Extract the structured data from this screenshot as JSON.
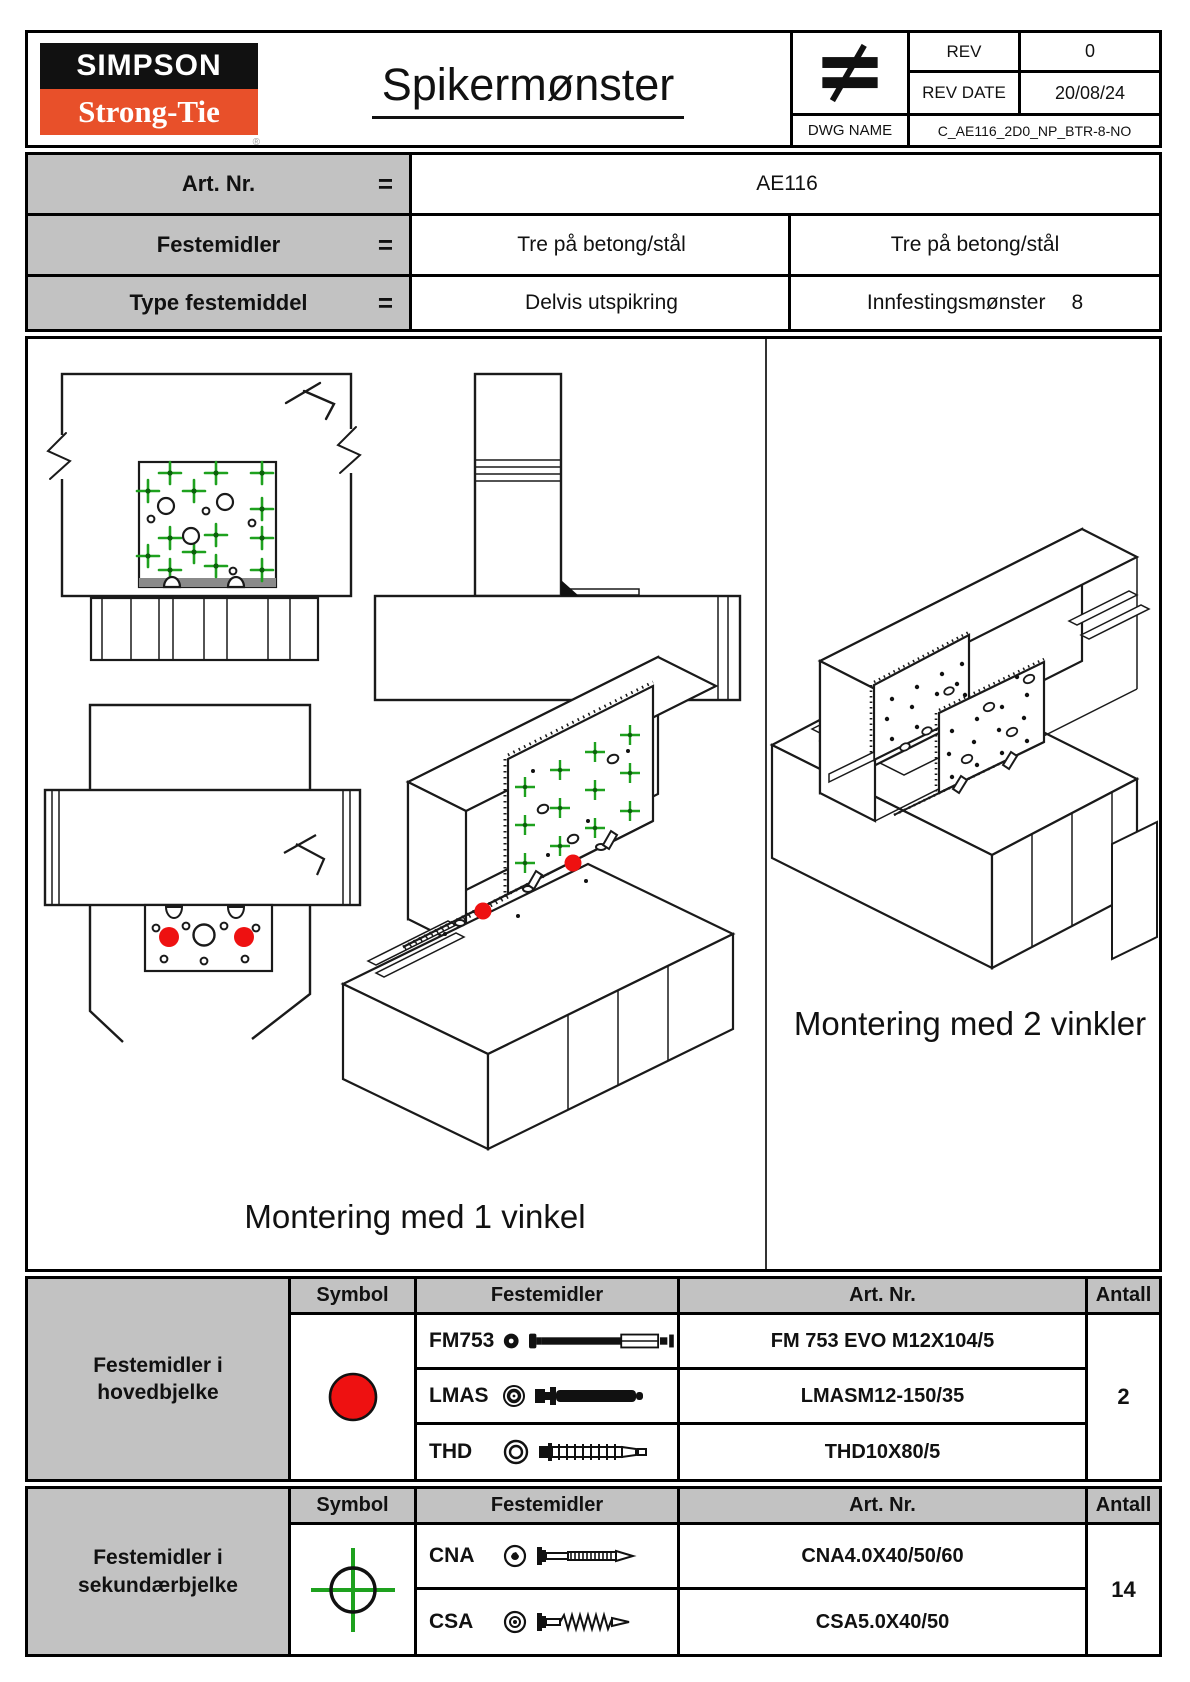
{
  "colors": {
    "logo_orange": "#e8502a",
    "cell_grey": "#c2c2c2",
    "marker_red": "#ee1111",
    "marker_green": "#1ea11e",
    "line_black": "#1a1a1a"
  },
  "header": {
    "logo": {
      "line1": "SIMPSON",
      "line2": "Strong-Tie",
      "registered": "®"
    },
    "title": "Spikermønster",
    "rev_label": "REV",
    "rev_value": "0",
    "rev_date_label": "REV DATE",
    "rev_date_value": "20/08/24",
    "dwg_label": "DWG NAME",
    "dwg_value": "C_AE116_2D0_NP_BTR-8-NO"
  },
  "info": {
    "rows": [
      {
        "label": "Art. Nr.",
        "eq": "=",
        "value": "AE116"
      },
      {
        "label": "Festemidler",
        "eq": "=",
        "value_left": "Tre på betong/stål",
        "value_right": "Tre på betong/stål"
      },
      {
        "label": "Type festemiddel",
        "eq": "=",
        "value_left": "Delvis utspikring",
        "value_right_label": "Innfestingsmønster",
        "value_right_number": "8"
      }
    ]
  },
  "drawings": {
    "caption_left": "Montering med 1 vinkel",
    "caption_right": "Montering med 2 vinkler"
  },
  "tables": [
    {
      "title_line1": "Festemidler i",
      "title_line2": "hovedbjelke",
      "headers": {
        "symbol": "Symbol",
        "festemidler": "Festemidler",
        "artnr": "Art. Nr.",
        "antall": "Antall"
      },
      "symbol_icon": "red-circle",
      "rows": [
        {
          "code": "FM753",
          "icon": "fm753-sleeve-bolt",
          "artnr": "FM 753 EVO M12X104/5"
        },
        {
          "code": "LMAS",
          "icon": "lmas-anchor-bolt",
          "artnr": "LMASM12-150/35"
        },
        {
          "code": "THD",
          "icon": "thd-concrete-screw",
          "artnr": "THD10X80/5"
        }
      ],
      "antall": "2"
    },
    {
      "title_line1": "Festemidler i",
      "title_line2": "sekundærbjelke",
      "headers": {
        "symbol": "Symbol",
        "festemidler": "Festemidler",
        "artnr": "Art. Nr.",
        "antall": "Antall"
      },
      "symbol_icon": "green-crosshair",
      "rows": [
        {
          "code": "CNA",
          "icon": "cna-anchor-nail",
          "artnr": "CNA4.0X40/50/60"
        },
        {
          "code": "CSA",
          "icon": "csa-anchor-screw",
          "artnr": "CSA5.0X40/50"
        }
      ],
      "antall": "14"
    }
  ]
}
